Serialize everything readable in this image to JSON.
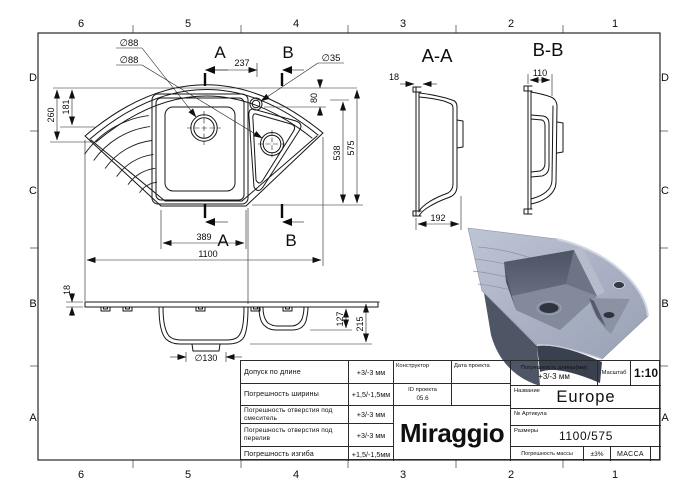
{
  "grid": {
    "columns": [
      "6",
      "5",
      "4",
      "3",
      "2",
      "1"
    ],
    "rows": [
      "D",
      "C",
      "B",
      "A"
    ]
  },
  "views": {
    "top": {
      "section_label_a": "A",
      "section_label_b": "B",
      "dia_main_drain": "∅88",
      "dia_second_drain": "∅88",
      "dia_tap_hole": "∅35",
      "dim_tap_offset": "237",
      "dim_tap_depth": "80",
      "dim_rim_depth": "181",
      "dim_wing_depth": "260",
      "dim_inner_depth": "538",
      "dim_total_depth": "575",
      "dim_bottom_width": "389",
      "dim_total_width": "1100"
    },
    "side": {
      "dim_rim_thickness": "18",
      "dim_small_bowl_depth": "127",
      "dim_total_height": "215",
      "dia_drain_outlet": "∅130"
    },
    "section_aa": {
      "title": "A-A",
      "dim_rim_lip": "18",
      "dim_depth": "192"
    },
    "section_bb": {
      "title": "B-B",
      "dim_width": "110"
    }
  },
  "title_block": {
    "tolerances": [
      {
        "label": "Допуск по длине",
        "value": "+3/-3 мм"
      },
      {
        "label": "Погрешность ширины",
        "value": "+1,5/-1,5мм"
      },
      {
        "label": "Погрешность отверстия под смеситель",
        "value": "+3/-3 мм"
      },
      {
        "label": "Погрешность отверстия под перелив",
        "value": "+3/-3 мм"
      },
      {
        "label": "Погрешность изгиба",
        "value": "+1,5/-1,5мм"
      }
    ],
    "designer_label": "Конструктор",
    "project_date_label": "Дата проекта",
    "project_id_label": "ID проекта",
    "project_id_value": "05.6",
    "logo": "Miraggio",
    "length_tolerance_label": "Погрешность длины(мм)",
    "length_tolerance_value": "+3/-3 мм",
    "scale_label": "Масштаб",
    "scale_value": "1:10",
    "name_label": "Название",
    "name_value": "Europe",
    "article_label": "№ Артикула",
    "size_label": "Размеры",
    "size_value": "1100/575",
    "mass_tolerance_label": "Погрешность массы",
    "mass_tolerance_value": "±3%",
    "mass_label": "МАССА"
  },
  "render": {
    "colors": {
      "body": "#aab1c4",
      "wall": "#575e6f",
      "dark": "#343b47",
      "floor": "#7f8798",
      "highlight": "#d2d7e2",
      "skirt": "#4e5565"
    }
  }
}
